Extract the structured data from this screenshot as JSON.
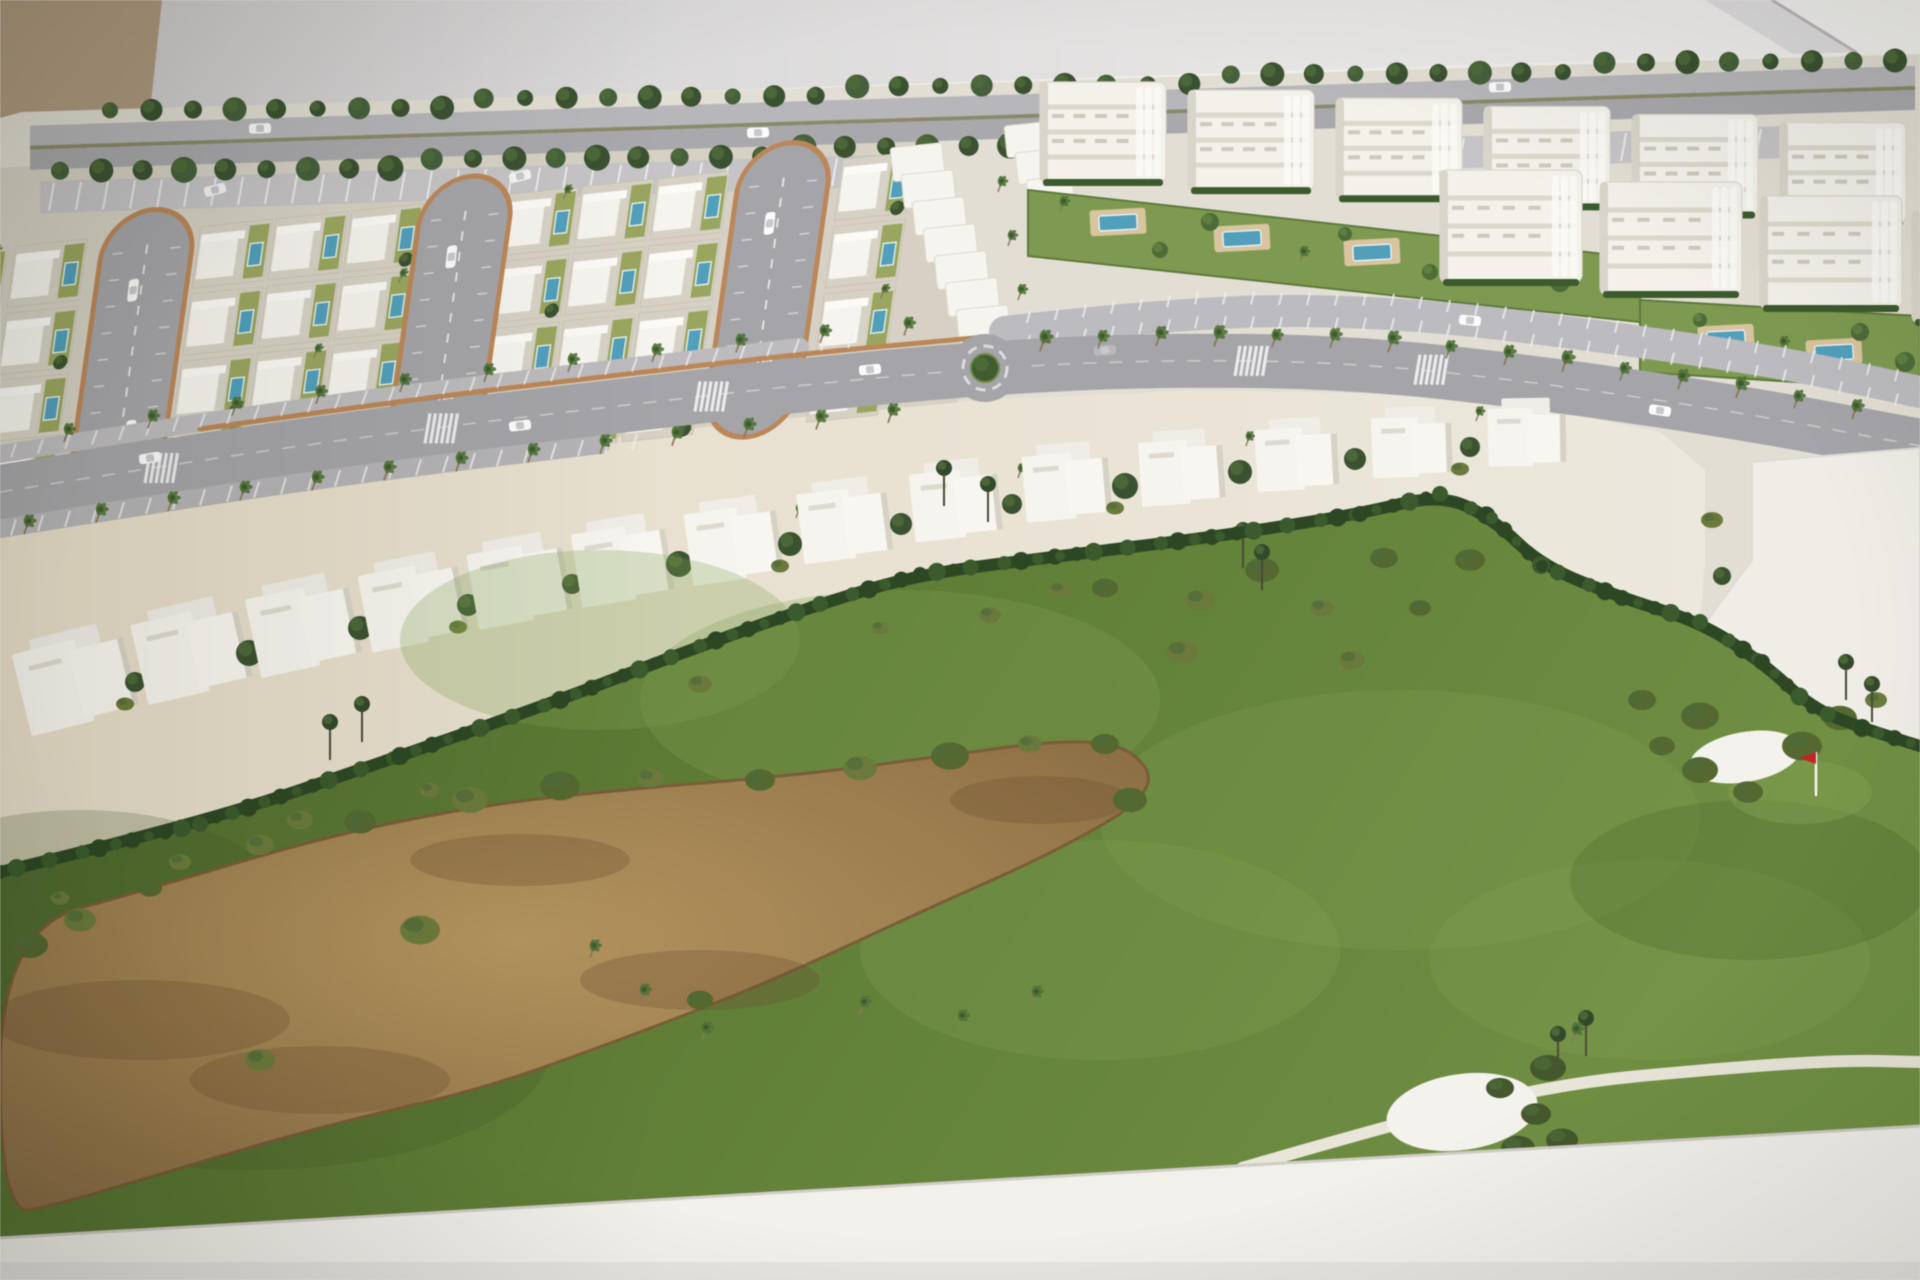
{
  "scene": {
    "kind": "photograph-of-architectural-scale-model",
    "subject": "aerial view of resort masterplan maquette: white villa grid with hairpin cul-de-sacs, apartment blocks with pools, palm-lined curved avenue with roundabout, townhouse row and golf course with waste bunker, sand bunkers, cart path and red pin flag",
    "width": 1920,
    "height": 1280
  },
  "palette": {
    "bg_left": "#cfcdce",
    "bg_right": "#f3f2f0",
    "corner_object": "#b29a80",
    "diag_band": "#dfdddf",
    "diag_line": "#b9b6b8",
    "base_white": "#f2f0ea",
    "ground": "#e2ded4",
    "villa_ground": "#d6d1c3",
    "band_left": "#e6dcc6",
    "band_right": "#ece8dd",
    "road": "#a5a4a8",
    "road_top_a": "#b7b6ba",
    "road_top_b": "#a9a8ac",
    "road_light": "#bcbbbf",
    "parking": "#c6c4c6",
    "median": "#8a8a6a",
    "curb_brick": "#bd8756",
    "lane_mark": "#dcdcde",
    "villa_white": "#f6f4ee",
    "villa_shadow": "#d7d2c6",
    "apt_white": "#f3f1ea",
    "apt_line": "#d8d3c8",
    "apt_hedge": "#3c5a2e",
    "pool_blue": "#4fa0bd",
    "pool_rim": "#e8f0f2",
    "pool_deck": "#d9c49c",
    "lawn": "#9aa65c",
    "tree_dark": "#3a5230",
    "tree_mid": "#4d6b38",
    "tree_light": "#61823f",
    "bush_olive": "#6b7a3a",
    "palm_crown": "#4f7236",
    "palm_trunk": "#8a7a5c",
    "hedge": "#2c4723",
    "hedge_hi": "#3a5a2c",
    "golf_dark": "#4e6a2c",
    "golf_mid": "#5d7c33",
    "golf_light": "#6f9040",
    "golf_patch": "#83a050",
    "sand_hi": "#b8965f",
    "sand_mid": "#9a784a",
    "sand_edge": "#7c5c36",
    "bunker": "#f4f2ec",
    "flag_red": "#c8241f",
    "flag_pole": "#f8f8f6",
    "cart_path": "#e9e5d8",
    "car_white": "#fbfbfb",
    "car_glass": "#c9c9cc",
    "white_parcel": "#efede6"
  },
  "model": {
    "top_edge": [
      [
        22,
        112
      ],
      [
        1912,
        52
      ]
    ],
    "bottom_band": [
      [
        0,
        1238
      ],
      [
        1920,
        1126
      ]
    ]
  },
  "background": {
    "corner": [
      [
        0,
        0
      ],
      [
        162,
        0
      ],
      [
        150,
        112
      ],
      [
        0,
        122
      ]
    ],
    "diag_band": [
      [
        1705,
        0
      ],
      [
        1772,
        0
      ],
      [
        1920,
        96
      ],
      [
        1920,
        132
      ]
    ],
    "diag_line": [
      [
        1772,
        0
      ],
      [
        1920,
        92
      ]
    ]
  },
  "perimeter": {
    "row_a": {
      "x0": 110,
      "x1": 1895,
      "n": 44,
      "dy": 5,
      "r": 10
    },
    "row_b": {
      "x0": 60,
      "x1": 1010,
      "n": 24,
      "dy": 64,
      "r": 11
    },
    "road": {
      "o1": 14,
      "o2": 34,
      "o3": 38,
      "o4": 58
    },
    "parking": [
      {
        "x0": 40,
        "x1": 930
      },
      {
        "x0": 1450,
        "x1": 1900
      }
    ],
    "parking_o": [
      70,
      102
    ],
    "cars": [
      [
        260,
        24
      ],
      [
        758,
        44
      ],
      [
        1500,
        22
      ]
    ],
    "vans": [
      [
        215,
        84
      ],
      [
        520,
        80
      ],
      [
        806,
        76
      ]
    ]
  },
  "villas": {
    "clip": [
      [
        0,
        168
      ],
      [
        910,
        126
      ],
      [
        1005,
        356
      ],
      [
        885,
        470
      ],
      [
        0,
        562
      ]
    ],
    "transform": "translate(-20,250) rotate(-6) skewX(-14)",
    "cols": [
      -44,
      36,
      222,
      298,
      374,
      530,
      606,
      682,
      868
    ],
    "rows": [
      0,
      66,
      132,
      198
    ],
    "plot": {
      "w": 72,
      "h": 60
    },
    "loops": {
      "cx": [
        170,
        490,
        810
      ],
      "w": 92,
      "y0": -22,
      "y1": 266
    }
  },
  "terraces": [
    {
      "x": 890,
      "y": 148,
      "n": 7,
      "dx": 11,
      "dy": 27,
      "w": 52,
      "h": 24
    },
    {
      "x": 1004,
      "y": 126,
      "n": 4,
      "dx": 11,
      "dy": 27,
      "w": 46,
      "h": 22
    }
  ],
  "terrace_palms": [
    [
      998,
      192
    ],
    [
      1008,
      246
    ],
    [
      1018,
      300
    ]
  ],
  "apartments": {
    "row1": {
      "x0": 1040,
      "step": 148,
      "n": 6,
      "w": 126,
      "h": 100,
      "y0": 82,
      "slope": 0.055
    },
    "row2": {
      "blocks": [
        [
          1440,
          170
        ],
        [
          1600,
          182
        ],
        [
          1760,
          196
        ],
        [
          1912,
          210
        ]
      ],
      "w": 142,
      "h": 112
    },
    "garden1": [
      [
        1028,
        190
      ],
      [
        1640,
        258
      ],
      [
        1640,
        322
      ],
      [
        1028,
        256
      ]
    ],
    "garden2": [
      [
        1640,
        300
      ],
      [
        1920,
        316
      ],
      [
        1920,
        390
      ],
      [
        1640,
        372
      ]
    ],
    "pools": [
      [
        1118,
        222
      ],
      [
        1242,
        238
      ],
      [
        1372,
        252
      ],
      [
        1726,
        338
      ],
      [
        1834,
        352
      ]
    ],
    "garden_trees": [
      [
        1060,
        212
      ],
      [
        1160,
        250
      ],
      [
        1210,
        222
      ],
      [
        1300,
        262
      ],
      [
        1345,
        234
      ],
      [
        1430,
        272
      ],
      [
        1520,
        252
      ],
      [
        1560,
        282
      ],
      [
        1700,
        320
      ],
      [
        1780,
        352
      ],
      [
        1860,
        332
      ],
      [
        1905,
        362
      ]
    ]
  },
  "service_road": {
    "pts": [
      [
        1005,
        332
      ],
      [
        1200,
        310
      ],
      [
        1400,
        312
      ],
      [
        1600,
        336
      ],
      [
        1780,
        362
      ],
      [
        1920,
        392
      ]
    ],
    "width": 32,
    "tick_step": 28,
    "x0": 1030,
    "x1": 1900
  },
  "avenue": {
    "pts": [
      [
        0,
        492
      ],
      [
        200,
        460
      ],
      [
        400,
        432
      ],
      [
        600,
        408
      ],
      [
        800,
        385
      ],
      [
        985,
        368
      ],
      [
        1150,
        360
      ],
      [
        1350,
        362
      ],
      [
        1550,
        384
      ],
      [
        1750,
        414
      ],
      [
        1920,
        446
      ]
    ],
    "width": 54,
    "roundabout": {
      "x": 985,
      "y": 368,
      "r": 34
    },
    "curb": {
      "x0": 240,
      "x1": 980,
      "offset": -31
    },
    "crosswalks": [
      150,
      430,
      700,
      1240,
      1420
    ],
    "cars": [
      [
        150,
        -10
      ],
      [
        520,
        8
      ],
      [
        870,
        -9
      ],
      [
        1105,
        -12
      ],
      [
        1660,
        10
      ]
    ],
    "palms_lower": {
      "x0": 24,
      "x1": 900,
      "step": 72,
      "offset": 46
    },
    "palms_upper": {
      "x0": 64,
      "x1": 920,
      "step": 84,
      "offset": -40
    },
    "palms_right": {
      "x0": 1040,
      "x1": 1900,
      "step": 58,
      "offset": -14
    },
    "park_lower": {
      "x0": 0,
      "x1": 640,
      "offset": 36,
      "w": 20
    },
    "park_upper": {
      "x0": 0,
      "x1": 880,
      "offset": -38,
      "w": 18
    }
  },
  "townhouses": {
    "units": [
      [
        20,
        640,
        112,
        84,
        -14
      ],
      [
        138,
        612,
        108,
        82,
        -13
      ],
      [
        252,
        588,
        104,
        80,
        -12
      ],
      [
        364,
        566,
        100,
        78,
        -11
      ],
      [
        472,
        546,
        96,
        76,
        -10
      ],
      [
        576,
        527,
        94,
        74,
        -9
      ],
      [
        688,
        508,
        92,
        72,
        -8
      ],
      [
        800,
        489,
        90,
        70,
        -7
      ],
      [
        912,
        470,
        88,
        68,
        -6
      ],
      [
        1024,
        453,
        86,
        66,
        -5
      ],
      [
        1140,
        440,
        84,
        64,
        -4
      ],
      [
        1256,
        428,
        82,
        62,
        -3
      ],
      [
        1372,
        417,
        80,
        60,
        -2
      ],
      [
        1488,
        408,
        78,
        58,
        -1
      ]
    ],
    "band_top": [
      [
        0,
        520
      ],
      [
        250,
        482
      ],
      [
        500,
        450
      ],
      [
        750,
        422
      ],
      [
        985,
        400
      ],
      [
        1200,
        390
      ],
      [
        1400,
        394
      ],
      [
        1560,
        412
      ],
      [
        1660,
        432
      ],
      [
        1705,
        470
      ],
      [
        1705,
        560
      ]
    ]
  },
  "hedge": [
    [
      0,
      872
    ],
    [
      200,
      824
    ],
    [
      400,
      756
    ],
    [
      560,
      700
    ],
    [
      700,
      646
    ],
    [
      820,
      604
    ],
    [
      920,
      574
    ],
    [
      1060,
      556
    ],
    [
      1220,
      536
    ],
    [
      1360,
      514
    ],
    [
      1440,
      494
    ],
    [
      1492,
      518
    ],
    [
      1542,
      566
    ],
    [
      1622,
      598
    ],
    [
      1700,
      622
    ],
    [
      1762,
      662
    ],
    [
      1812,
      708
    ],
    [
      1862,
      728
    ],
    [
      1920,
      746
    ]
  ],
  "hedge_band_end_index": 15,
  "parcel": {
    "poly": [
      [
        1752,
        462
      ],
      [
        1920,
        448
      ],
      [
        1920,
        742
      ],
      [
        1862,
        728
      ],
      [
        1812,
        708
      ],
      [
        1706,
        622
      ],
      [
        1752,
        560
      ]
    ],
    "trees": [
      [
        1712,
        520
      ],
      [
        1722,
        576
      ],
      [
        1736,
        652
      ],
      [
        1708,
        688
      ],
      [
        1876,
        700
      ]
    ]
  },
  "golf": {
    "mottles_light": [
      [
        900,
        700,
        260,
        110
      ],
      [
        1400,
        820,
        300,
        130
      ],
      [
        600,
        640,
        200,
        90
      ],
      [
        1650,
        960,
        220,
        100
      ],
      [
        1100,
        950,
        240,
        110
      ]
    ],
    "mottles_dark": [
      [
        250,
        1050,
        300,
        120
      ],
      [
        80,
        900,
        200,
        90
      ],
      [
        1750,
        880,
        180,
        80
      ]
    ],
    "sand": [
      [
        0,
        930
      ],
      [
        160,
        886
      ],
      [
        320,
        838
      ],
      [
        480,
        805
      ],
      [
        640,
        788
      ],
      [
        800,
        775
      ],
      [
        950,
        755
      ],
      [
        1060,
        740
      ],
      [
        1130,
        745
      ],
      [
        1160,
        790
      ],
      [
        1060,
        850
      ],
      [
        920,
        912
      ],
      [
        770,
        982
      ],
      [
        620,
        1040
      ],
      [
        480,
        1090
      ],
      [
        330,
        1124
      ],
      [
        180,
        1168
      ],
      [
        60,
        1204
      ],
      [
        0,
        1216
      ]
    ],
    "sand_streaks": [
      [
        140,
        1020,
        150,
        40
      ],
      [
        320,
        1080,
        130,
        34
      ],
      [
        700,
        980,
        120,
        30
      ],
      [
        1040,
        800,
        90,
        24
      ],
      [
        520,
        860,
        110,
        26
      ]
    ],
    "sand_bushes": [
      [
        150,
        888
      ],
      [
        260,
        845
      ],
      [
        360,
        822
      ],
      [
        470,
        800
      ],
      [
        560,
        786
      ],
      [
        650,
        778
      ],
      [
        760,
        780
      ],
      [
        860,
        768
      ],
      [
        950,
        756
      ],
      [
        1030,
        744
      ],
      [
        1105,
        744
      ],
      [
        80,
        920
      ],
      [
        30,
        945
      ],
      [
        420,
        930
      ],
      [
        700,
        1000
      ],
      [
        260,
        1060
      ],
      [
        1130,
        800
      ]
    ],
    "palms": [
      [
        590,
        958
      ],
      [
        640,
        1002
      ],
      [
        702,
        1040
      ],
      [
        860,
        1014
      ],
      [
        958,
        1028
      ],
      [
        1032,
        1004
      ]
    ],
    "hedge_bushes": [
      [
        60,
        898
      ],
      [
        180,
        862
      ],
      [
        300,
        820
      ],
      [
        430,
        790
      ],
      [
        700,
        684
      ],
      [
        880,
        628
      ],
      [
        1060,
        590
      ]
    ],
    "upper_bushes": [
      [
        990,
        615
      ],
      [
        1105,
        588
      ],
      [
        1200,
        600
      ],
      [
        1262,
        570
      ],
      [
        1322,
        608
      ],
      [
        1384,
        558
      ],
      [
        1182,
        652
      ],
      [
        1420,
        608
      ],
      [
        1352,
        660
      ],
      [
        1470,
        560
      ]
    ],
    "tall_trees": [
      [
        330,
        760
      ],
      [
        362,
        742
      ],
      [
        944,
        506
      ],
      [
        988,
        522
      ],
      [
        1846,
        700
      ],
      [
        1872,
        722
      ],
      [
        1558,
        1072
      ],
      [
        1586,
        1056
      ],
      [
        1243,
        568
      ],
      [
        1262,
        590
      ]
    ],
    "bunker1": {
      "x": 1745,
      "y": 757,
      "rx": 56,
      "ry": 25,
      "rot": -10
    },
    "bunker1_bushes": [
      [
        1662,
        746
      ],
      [
        1700,
        770
      ],
      [
        1748,
        792
      ],
      [
        1802,
        746
      ],
      [
        1840,
        718
      ],
      [
        1642,
        700
      ],
      [
        1700,
        716
      ]
    ],
    "green1": {
      "x": 1800,
      "y": 792,
      "rx": 72,
      "ry": 32
    },
    "flag": {
      "x": 1816,
      "y": 796
    },
    "bunker2": {
      "x": 1462,
      "y": 1112,
      "rx": 76,
      "ry": 38,
      "rot": -8
    },
    "cluster2": [
      [
        1500,
        1088
      ],
      [
        1536,
        1114
      ],
      [
        1562,
        1140
      ],
      [
        1518,
        1148
      ],
      [
        1548,
        1068
      ]
    ],
    "cluster2_palm": [
      1572,
      1042
    ],
    "cart_path": [
      [
        1242,
        1168
      ],
      [
        1400,
        1122
      ],
      [
        1560,
        1084
      ],
      [
        1700,
        1070
      ],
      [
        1840,
        1060
      ],
      [
        1920,
        1062
      ]
    ]
  }
}
